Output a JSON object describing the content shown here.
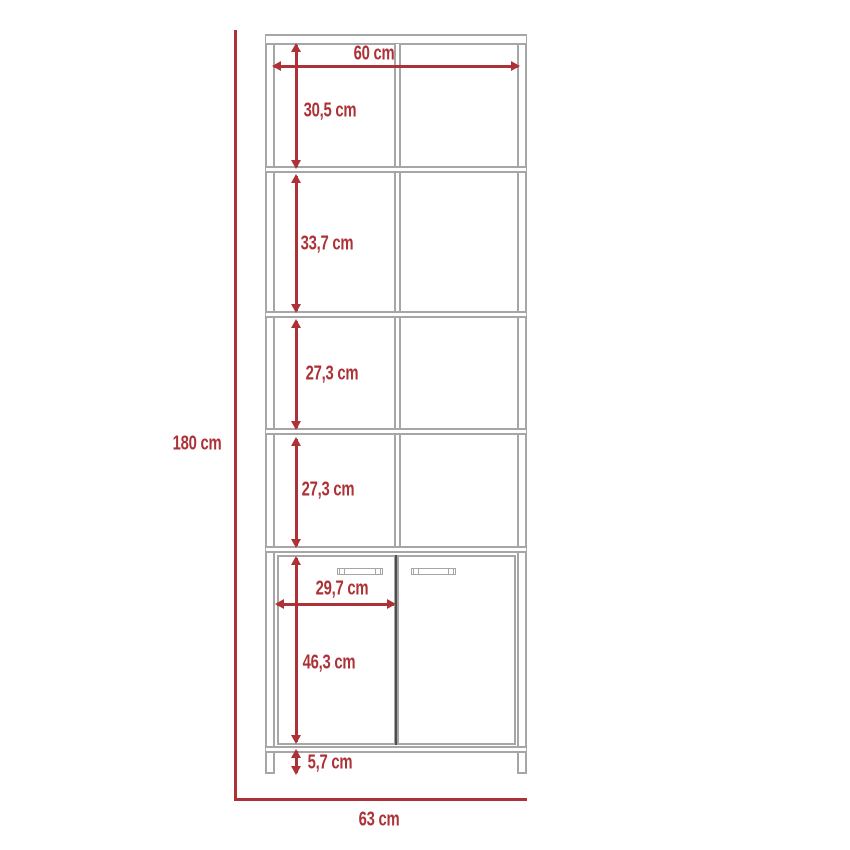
{
  "diagram": {
    "type": "furniture-dimension-drawing",
    "subject": "tall bookcase with four open shelf sections and a two-door base cabinet",
    "unit": "cm",
    "colors": {
      "dimension_red": "#ac3237",
      "frame_gray": "#a6a6a6",
      "door_gap": "#4d4d4d"
    },
    "overall": {
      "height_label": "180 cm",
      "height_value": 180,
      "top_width_label": "60 cm",
      "top_width_value": 60,
      "base_width_label": "63 cm",
      "base_width_value": 63
    },
    "sections": [
      {
        "name": "shelf-section-1",
        "label": "30,5 cm",
        "value": 30.5
      },
      {
        "name": "shelf-section-2",
        "label": "33,7 cm",
        "value": 33.7
      },
      {
        "name": "shelf-section-3",
        "label": "27,3 cm",
        "value": 27.3
      },
      {
        "name": "shelf-section-4",
        "label": "27,3 cm",
        "value": 27.3
      }
    ],
    "cabinet": {
      "door_width_label": "29,7 cm",
      "door_width_value": 29.7,
      "door_height_label": "46,3 cm",
      "door_height_value": 46.3,
      "plinth_height_label": "5,7 cm",
      "plinth_height_value": 5.7,
      "doors": 2,
      "handles": 2
    }
  }
}
